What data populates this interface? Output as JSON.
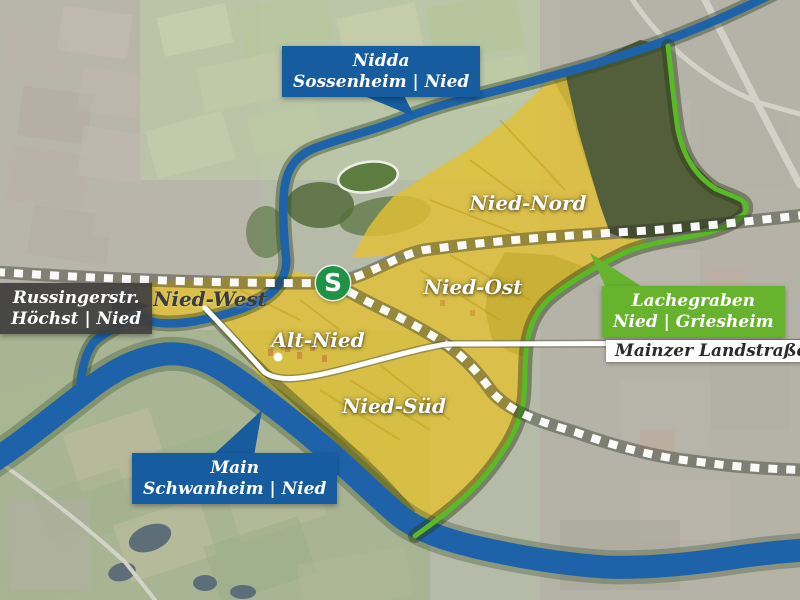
{
  "callouts": {
    "nidda": {
      "line1": "Nidda",
      "line2": "Sossenheim | Nied"
    },
    "russingerstr": {
      "line1": "Russingerstr.",
      "line2": "Höchst | Nied"
    },
    "lachegraben": {
      "line1": "Lachegraben",
      "line2": "Nied | Griesheim"
    },
    "main_river": {
      "line1": "Main",
      "line2": "Schwanheim | Nied"
    },
    "mainzer_landstrasse": {
      "label": "Mainzer Landstraße"
    }
  },
  "districts": {
    "nied_nord": "Nied-Nord",
    "nied_ost": "Nied-Ost",
    "nied_west": "Nied-West",
    "alt_nied": "Alt-Nied",
    "nied_sued": "Nied-Süd"
  },
  "markers": {
    "sbahn_symbol": "S"
  },
  "colors": {
    "water": "#1e63a9",
    "district_yellow": "#e2c135",
    "boundary_green": "#58bb25",
    "callout_blue": "#175c9e",
    "callout_green": "#67b32e",
    "callout_dark": "#3e3e3e",
    "sbahn_green": "#1f9246",
    "railway_white": "#ffffff"
  }
}
